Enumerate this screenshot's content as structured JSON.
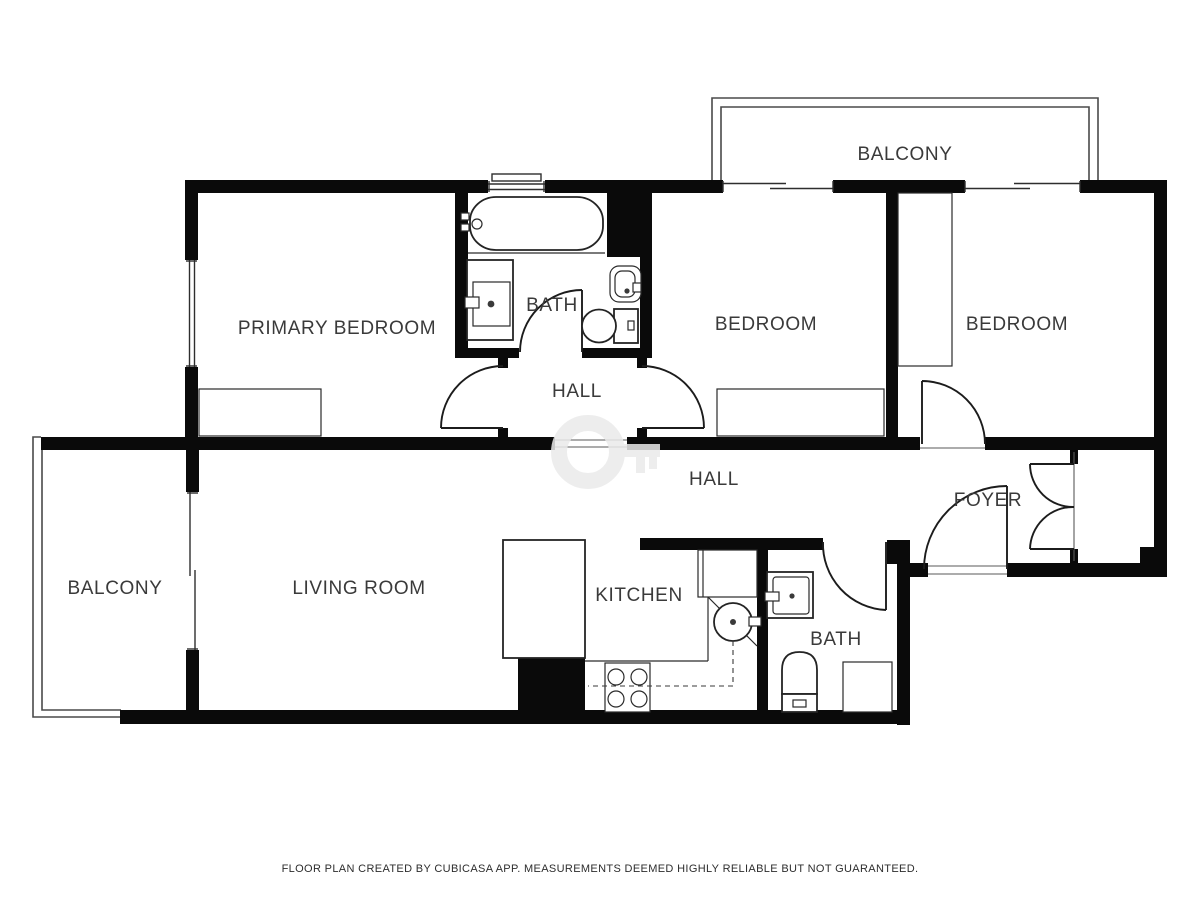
{
  "rooms": {
    "balcony_top": {
      "label": "BALCONY"
    },
    "primary_bedroom": {
      "label": "PRIMARY BEDROOM"
    },
    "bath1": {
      "label": "BATH"
    },
    "bedroom2": {
      "label": "BEDROOM"
    },
    "bedroom3": {
      "label": "BEDROOM"
    },
    "hall_upper": {
      "label": "HALL"
    },
    "hall_lower": {
      "label": "HALL"
    },
    "foyer": {
      "label": "FOYER"
    },
    "balcony_left": {
      "label": "BALCONY"
    },
    "living_room": {
      "label": "LIVING ROOM"
    },
    "kitchen": {
      "label": "KITCHEN"
    },
    "bath2": {
      "label": "BATH"
    }
  },
  "footer": {
    "disclaimer": "FLOOR PLAN CREATED BY CUBICASA APP. MEASUREMENTS DEEMED HIGHLY RELIABLE BUT NOT GUARANTEED."
  },
  "colors": {
    "wall": "#0a0a0a",
    "label_text": "#3a3a3a",
    "fixture_line": "#242424",
    "watermark": "#ebebeb",
    "background": "#ffffff"
  }
}
